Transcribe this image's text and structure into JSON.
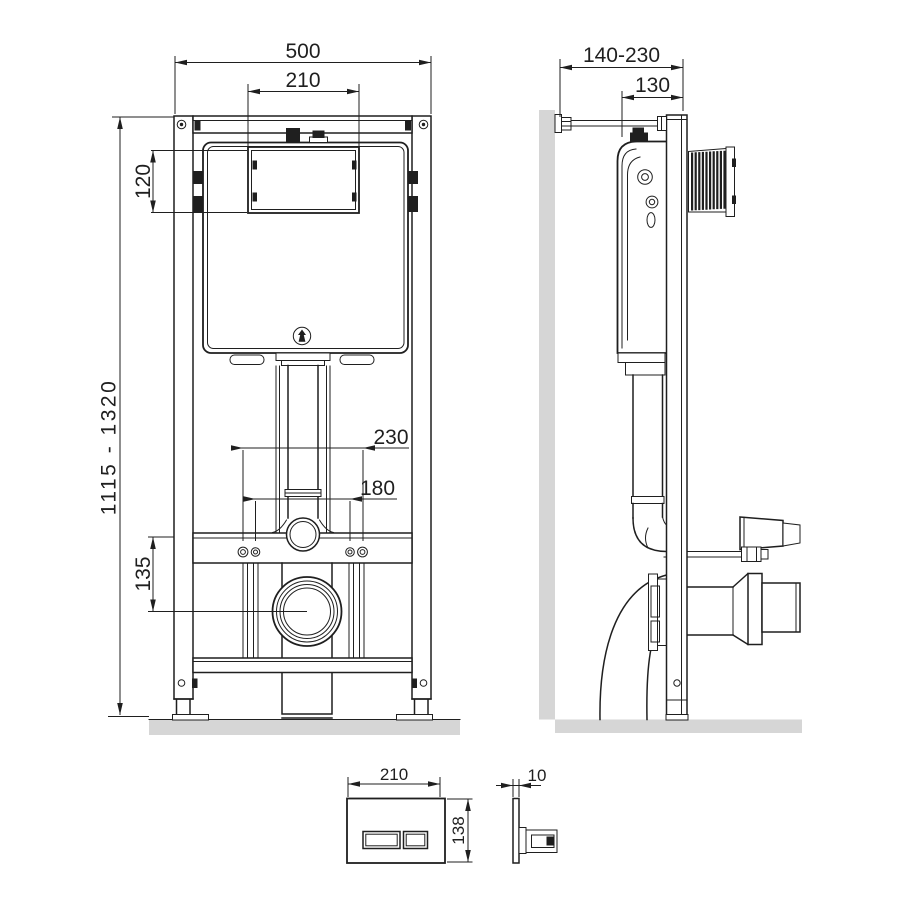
{
  "title": "wc-installation-frame-dimension-drawing",
  "colors": {
    "line": "#1f1f1f",
    "surface_gray": "#d6d6d6",
    "background": "#ffffff"
  },
  "front": {
    "overall_width": "500",
    "opening_width": "210",
    "opening_height": "120",
    "install_height": "1115 - 1320",
    "fixing_span_outer": "230",
    "fixing_span_inner": "180",
    "outlet_offset": "135"
  },
  "side": {
    "wall_distance": "140-230",
    "depth": "130"
  },
  "plate": {
    "width": "210",
    "height": "138",
    "thickness": "10"
  }
}
